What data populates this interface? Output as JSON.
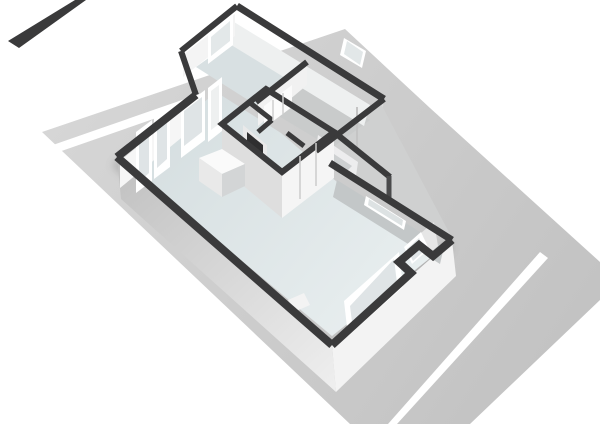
{
  "canvas": {
    "width": 600,
    "height": 424,
    "background": "#ffffff"
  },
  "palette": {
    "wall_top_dark": "#3a3a3b",
    "wall_top_soft": "#4a4a4b",
    "wall_face_light": "#f5f5f5",
    "wall_face_mid": "#dedede",
    "wall_face_shade": "#c3c7c8",
    "floor_blue": "#dce4e6",
    "floor_blue_dark": "#d8e0e2",
    "floor_gray": "#c9cbcb",
    "plot_gray": "#cccccc",
    "road_stripe": "#ffffff",
    "glass": "#dfe4e6",
    "fireplace_niche": "#2f2f30"
  },
  "scene": {
    "shapes": [
      {
        "name": "plot-ground",
        "kind": "polygon",
        "points": "42,132 345,29 430,108 600,262 600,300 470,424 350,424",
        "fill": "url(#gradPlot)"
      },
      {
        "name": "road-stripe-nw",
        "kind": "polygon",
        "points": "50,146 205,92 205,101 50,155",
        "fill": "#ffffff"
      },
      {
        "name": "road-stripe-se",
        "kind": "polygon",
        "points": "388,424 540,252 548,258 397,424",
        "fill": "#ffffff"
      },
      {
        "name": "neighbor-wall-top",
        "kind": "polygon",
        "points": "8,41 75,0 86,0 19,48",
        "fill": "#3a3a3b"
      },
      {
        "name": "building-ground-shadow",
        "kind": "path",
        "d": "M115,162 L330,350 L450,245",
        "fill": "none",
        "stroke": "rgba(0,0,0,0.16)",
        "width": 10,
        "filter": "url(#softBlur)"
      },
      {
        "name": "exterior-wall-face-sw",
        "kind": "polygon",
        "points": "117,157 332,345 336,392 121,199",
        "fill": "url(#gradSW)"
      },
      {
        "name": "exterior-wall-face-se",
        "kind": "polygon",
        "points": "332,345 452,240 456,276 336,392",
        "fill": "#f3f3f3"
      },
      {
        "name": "wing-wall-face-se",
        "kind": "polygon",
        "points": "316,151 384,99 378,141 324,173",
        "fill": "#d9d9d9"
      },
      {
        "name": "plot-patch-ne",
        "kind": "polygon",
        "points": "320,150 381,104 452,238 341,166",
        "fill": "#cfd0d0"
      },
      {
        "name": "floor-living-room",
        "kind": "polygon",
        "points": "127,165 203,103 216,92 281,133 337,182 444,247 332,336",
        "fill": "url(#gradFloor)"
      },
      {
        "name": "floor-top-room",
        "kind": "polygon",
        "points": "196,67 231,42 290,78 256,105",
        "fill": "#d8e0e2"
      },
      {
        "name": "floor-top-right-room",
        "kind": "polygon",
        "points": "262,106 300,80 370,120 332,148",
        "fill": "#c9cbcb"
      },
      {
        "name": "mid-room-wall-face",
        "kind": "polygon",
        "points": "318,135 358,162 356,176 316,149",
        "fill": "#ededee"
      },
      {
        "name": "mid-room-floor",
        "kind": "polygon",
        "points": "322,146 352,166 342,176 317,154",
        "fill": "#cdd0d1"
      },
      {
        "name": "ne-wall-inner-face-top",
        "kind": "polygon",
        "points": "234,22 370,105 364,126 228,43",
        "fill": "#eef0f0"
      },
      {
        "name": "top-right-window-frame",
        "kind": "polygon",
        "points": "344,38 366,51 362,68 340,55",
        "fill": "#ffffff"
      },
      {
        "name": "top-right-window-glass",
        "kind": "polygon",
        "points": "347,41 363,52 360,65 344,54",
        "fill": "#e2e7e8"
      },
      {
        "name": "nw-wall-inner-face",
        "kind": "polygon",
        "points": "120,161 197,98 197,125 120,188",
        "fill": "#f6f6f6"
      },
      {
        "name": "french-door-left-frame",
        "kind": "polygon",
        "points": "136,132 152,120 152,181 136,193",
        "fill": "#ffffff"
      },
      {
        "name": "french-door-left-glass",
        "kind": "polygon",
        "points": "139,135 149,127 149,173 139,182",
        "fill": "#dfe4e6"
      },
      {
        "name": "french-door-right-frame",
        "kind": "polygon",
        "points": "154,118 170,106 170,167 154,179",
        "fill": "#ffffff"
      },
      {
        "name": "french-door-right-glass",
        "kind": "polygon",
        "points": "157,121 167,113 167,159 157,168",
        "fill": "#dfe4e6"
      },
      {
        "name": "nw-window-frame",
        "kind": "polygon",
        "points": "181,108 205,90 205,140 181,158",
        "fill": "#ffffff"
      },
      {
        "name": "nw-window-glass",
        "kind": "polygon",
        "points": "184,111 202,97 202,132 184,146",
        "fill": "#dfe4e6"
      },
      {
        "name": "nw-door-frame",
        "kind": "polygon",
        "points": "208,88 222,77 222,131 208,142",
        "fill": "#ffffff"
      },
      {
        "name": "nw-door-panel",
        "kind": "polygon",
        "points": "211,91 219,85 219,124 211,130",
        "fill": "#eef0f0"
      },
      {
        "name": "top-room-nw-face",
        "kind": "polygon",
        "points": "183,55 235,14 235,36 183,77",
        "fill": "#f4f4f4"
      },
      {
        "name": "top-room-window-frame",
        "kind": "polygon",
        "points": "208,34 233,15 233,45 208,64",
        "fill": "#ffffff"
      },
      {
        "name": "top-room-window-glass",
        "kind": "polygon",
        "points": "211,37 230,21 230,41 211,56",
        "fill": "#e3e8e9"
      },
      {
        "name": "divider-wall-face",
        "kind": "polygon",
        "points": "258,104 307,63 307,85 258,126",
        "fill": "#f1f1f1"
      },
      {
        "name": "closet-doors",
        "kind": "polygon",
        "points": "264,106 292,85 292,107 264,128",
        "fill": "#fbfbfb"
      },
      {
        "name": "bathroom-block-face-sw",
        "kind": "polygon",
        "points": "222,124 282,172 282,218 222,168",
        "fill": "#dedede"
      },
      {
        "name": "bathroom-block-face-se",
        "kind": "polygon",
        "points": "282,172 334,132 334,178 282,218",
        "fill": "#f5f5f5"
      },
      {
        "name": "fireplace-surround",
        "kind": "polygon",
        "points": "243,125 267,145 267,159 243,139",
        "fill": "#e9e9e9"
      },
      {
        "name": "fireplace-niche",
        "kind": "polygon",
        "points": "247,132 263,145 263,154 247,141",
        "fill": "#2f2f30"
      },
      {
        "name": "kitchen-island-top",
        "kind": "polygon",
        "points": "199,158 222,149 245,164 222,174",
        "fill": "#fafafa"
      },
      {
        "name": "kitchen-island-left",
        "kind": "polygon",
        "points": "199,158 222,174 222,197 199,181",
        "fill": "#e9e9e9"
      },
      {
        "name": "kitchen-island-right",
        "kind": "polygon",
        "points": "222,174 245,164 245,186 222,197",
        "fill": "#d3d5d6"
      },
      {
        "name": "ne-wall-inner-face-main",
        "kind": "polygon",
        "points": "337,180 444,247 440,264 333,197",
        "fill": "#c3c7c8"
      },
      {
        "name": "slot-window-frame",
        "kind": "polygon",
        "points": "366,196 406,221 404,230 364,205",
        "fill": "#ffffff"
      },
      {
        "name": "slot-window-glass",
        "kind": "polygon",
        "points": "369,199 403,220 402,226 368,205",
        "fill": "#dde2e3"
      },
      {
        "name": "se-window-frame",
        "kind": "polygon",
        "points": "344,301 399,252 403,287 348,336",
        "fill": "#ffffff"
      },
      {
        "name": "se-window-glass",
        "kind": "polygon",
        "points": "350,306 394,259 397,283 353,330",
        "fill": "#dfe4e6"
      },
      {
        "name": "notch-wall-face",
        "kind": "polygon",
        "points": "421,233 434,222 438,246 425,257",
        "fill": "#e6e6e6"
      },
      {
        "name": "notch-window-frame",
        "kind": "polygon",
        "points": "404,247 421,232 429,249 412,264",
        "fill": "#ffffff"
      },
      {
        "name": "notch-window-glass",
        "kind": "polygon",
        "points": "407,249 419,238 425,250 413,261",
        "fill": "#dfe4e6"
      },
      {
        "name": "window-sill-patch",
        "kind": "polygon",
        "points": "288,300 304,293 310,305 294,312",
        "fill": "#f3f3f3"
      },
      {
        "name": "wing-door-seam",
        "kind": "path",
        "d": "M357,107 L357,148",
        "fill": "none",
        "stroke": "#c4c4c4",
        "width": 2
      },
      {
        "name": "wall-top-nw-main",
        "kind": "path",
        "d": "M117,157 L196,95",
        "fill": "none",
        "stroke": "#3a3a3b",
        "width": 8
      },
      {
        "name": "wall-top-wing-sw",
        "kind": "path",
        "d": "M196,95 L181,51",
        "fill": "none",
        "stroke": "#3a3a3b",
        "width": 6
      },
      {
        "name": "wall-top-top-room-nw",
        "kind": "path",
        "d": "M181,51 L237,6",
        "fill": "none",
        "stroke": "#3a3a3b",
        "width": 6
      },
      {
        "name": "wall-top-ne-long",
        "kind": "path",
        "d": "M237,6 L384,99",
        "fill": "none",
        "stroke": "#3a3a3b",
        "width": 7
      },
      {
        "name": "wall-top-wing-se",
        "kind": "path",
        "d": "M384,99 L316,151",
        "fill": "none",
        "stroke": "#3a3a3b",
        "width": 6
      },
      {
        "name": "wall-top-room-divider",
        "kind": "path",
        "d": "M307,62 L256,102",
        "fill": "none",
        "stroke": "#3a3a3b",
        "width": 6
      },
      {
        "name": "wall-top-ext",
        "kind": "path",
        "d": "M334,132 L390,177",
        "fill": "none",
        "stroke": "#3a3a3b",
        "width": 6
      },
      {
        "name": "wall-top-ext-drop",
        "kind": "path",
        "d": "M389,176 L389,198",
        "fill": "none",
        "stroke": "#4a4a4b",
        "width": 5
      },
      {
        "name": "wall-top-ne-main",
        "kind": "path",
        "d": "M330,163 L452,240",
        "fill": "none",
        "stroke": "#3a3a3b",
        "width": 7
      },
      {
        "name": "wall-top-se-notch",
        "kind": "path",
        "d": "M452,240 L433,256 L419,245 L399,262 L411,273 L332,345",
        "fill": "none",
        "stroke": "#3a3a3b",
        "width": 8
      },
      {
        "name": "wall-top-sw",
        "kind": "path",
        "d": "M332,345 L117,157",
        "fill": "none",
        "stroke": "#3a3a3b",
        "width": 8
      },
      {
        "name": "bathroom-block-ring",
        "kind": "path",
        "d": "M222,124 L266,89 L334,132 L282,172 Z",
        "fill": "none",
        "stroke": "#3a3a3b",
        "width": 6
      },
      {
        "name": "bathroom-inner-wall-1",
        "kind": "path",
        "d": "M249,102 L272,120",
        "fill": "none",
        "stroke": "#3a3a3b",
        "width": 5
      },
      {
        "name": "bathroom-inner-wall-2",
        "kind": "path",
        "d": "M287,133 L304,146",
        "fill": "none",
        "stroke": "#3a3a3b",
        "width": 5
      },
      {
        "name": "bathroom-inner-wall-3",
        "kind": "path",
        "d": "M272,120 L258,132",
        "fill": "none",
        "stroke": "#3a3a3b",
        "width": 5
      },
      {
        "name": "closet-door-seams",
        "kind": "path",
        "d": "M273,100 L273,121 M283,93 L283,114",
        "fill": "none",
        "stroke": "#d0d0d0",
        "width": 1.5
      },
      {
        "name": "bathroom-door-seams",
        "kind": "path",
        "d": "M300,156 L300,199 M316,143 L316,186",
        "fill": "none",
        "stroke": "#cccccc",
        "width": 1.5
      }
    ]
  }
}
